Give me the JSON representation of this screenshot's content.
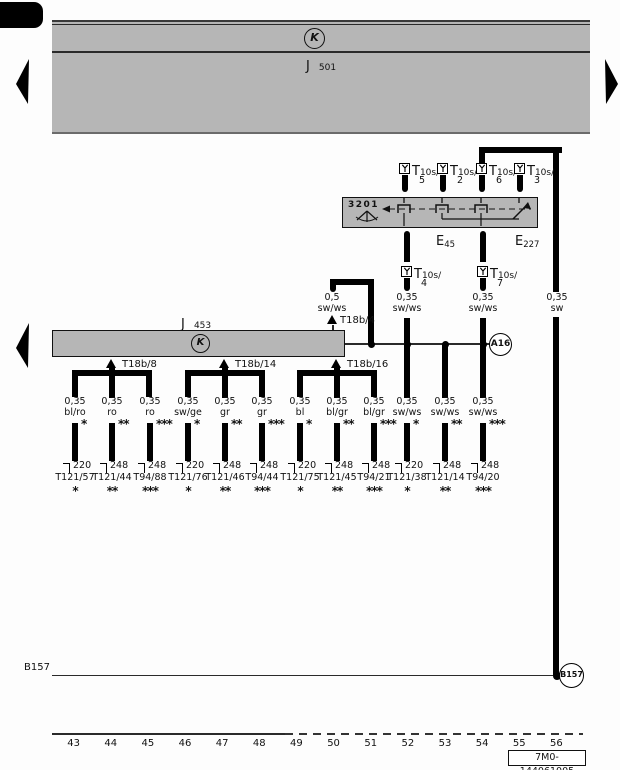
{
  "page": {
    "part_number": "7M0-144061005",
    "tracks": [
      "43",
      "44",
      "45",
      "46",
      "47",
      "48",
      "49",
      "50",
      "51",
      "52",
      "53",
      "54",
      "55",
      "56"
    ]
  },
  "j501": {
    "name": "J",
    "num": "501",
    "symbol": "K"
  },
  "j453": {
    "name": "J",
    "num": "453",
    "symbol": "K"
  },
  "unit3201": {
    "id": "3201"
  },
  "e45": {
    "name": "E",
    "num": "45"
  },
  "e227": {
    "name": "E",
    "num": "227"
  },
  "a16": {
    "label": "A16"
  },
  "b157": {
    "left_label": "B157",
    "circle_label": "B157"
  },
  "top_connectors": [
    {
      "label": "T",
      "sub": "10s/",
      "pin": "5"
    },
    {
      "label": "T",
      "sub": "10s/",
      "pin": "2"
    },
    {
      "label": "T",
      "sub": "10s/",
      "pin": "6"
    },
    {
      "label": "T",
      "sub": "10s/",
      "pin": "3"
    }
  ],
  "mid_connectors": [
    {
      "label": "T",
      "sub": "10s/",
      "pin": "4",
      "size": "0,35",
      "color": "sw/ws"
    },
    {
      "label": "T",
      "sub": "10s/",
      "pin": "7",
      "size": "0,35",
      "color": "sw/ws"
    }
  ],
  "right_wire": {
    "size": "0,35",
    "color": "sw"
  },
  "t18b4_wire": {
    "size": "0,5",
    "color": "sw/ws",
    "label": "T18b/4"
  },
  "branch_labels": [
    "T18b/8",
    "T18b/14",
    "T18b/16"
  ],
  "columns": [
    {
      "size": "0,35",
      "color": "bl/ro",
      "star": "*",
      "num": "220",
      "term": "T121/57",
      "star2": "*"
    },
    {
      "size": "0,35",
      "color": "ro",
      "star": "**",
      "num": "248",
      "term": "T121/44",
      "star2": "**"
    },
    {
      "size": "0,35",
      "color": "ro",
      "star": "***",
      "num": "248",
      "term": "T94/88",
      "star2": "***"
    },
    {
      "size": "0,35",
      "color": "sw/ge",
      "star": "*",
      "num": "220",
      "term": "T121/76",
      "star2": "*"
    },
    {
      "size": "0,35",
      "color": "gr",
      "star": "**",
      "num": "248",
      "term": "T121/46",
      "star2": "**"
    },
    {
      "size": "0,35",
      "color": "gr",
      "star": "***",
      "num": "248",
      "term": "T94/44",
      "star2": "***"
    },
    {
      "size": "0,35",
      "color": "bl",
      "star": "*",
      "num": "220",
      "term": "T121/75",
      "star2": "*"
    },
    {
      "size": "0,35",
      "color": "bl/gr",
      "star": "**",
      "num": "248",
      "term": "T121/45",
      "star2": "**"
    },
    {
      "size": "0,35",
      "color": "bl/gr",
      "star": "***",
      "num": "248",
      "term": "T94/21",
      "star2": "***"
    },
    {
      "size": "0,35",
      "color": "sw/ws",
      "star": "*",
      "num": "220",
      "term": "T121/38",
      "star2": "*"
    },
    {
      "size": "0,35",
      "color": "sw/ws",
      "star": "**",
      "num": "248",
      "term": "T121/14",
      "star2": "**"
    },
    {
      "size": "0,35",
      "color": "sw/ws",
      "star": "***",
      "num": "248",
      "term": "T94/20",
      "star2": "***"
    }
  ]
}
